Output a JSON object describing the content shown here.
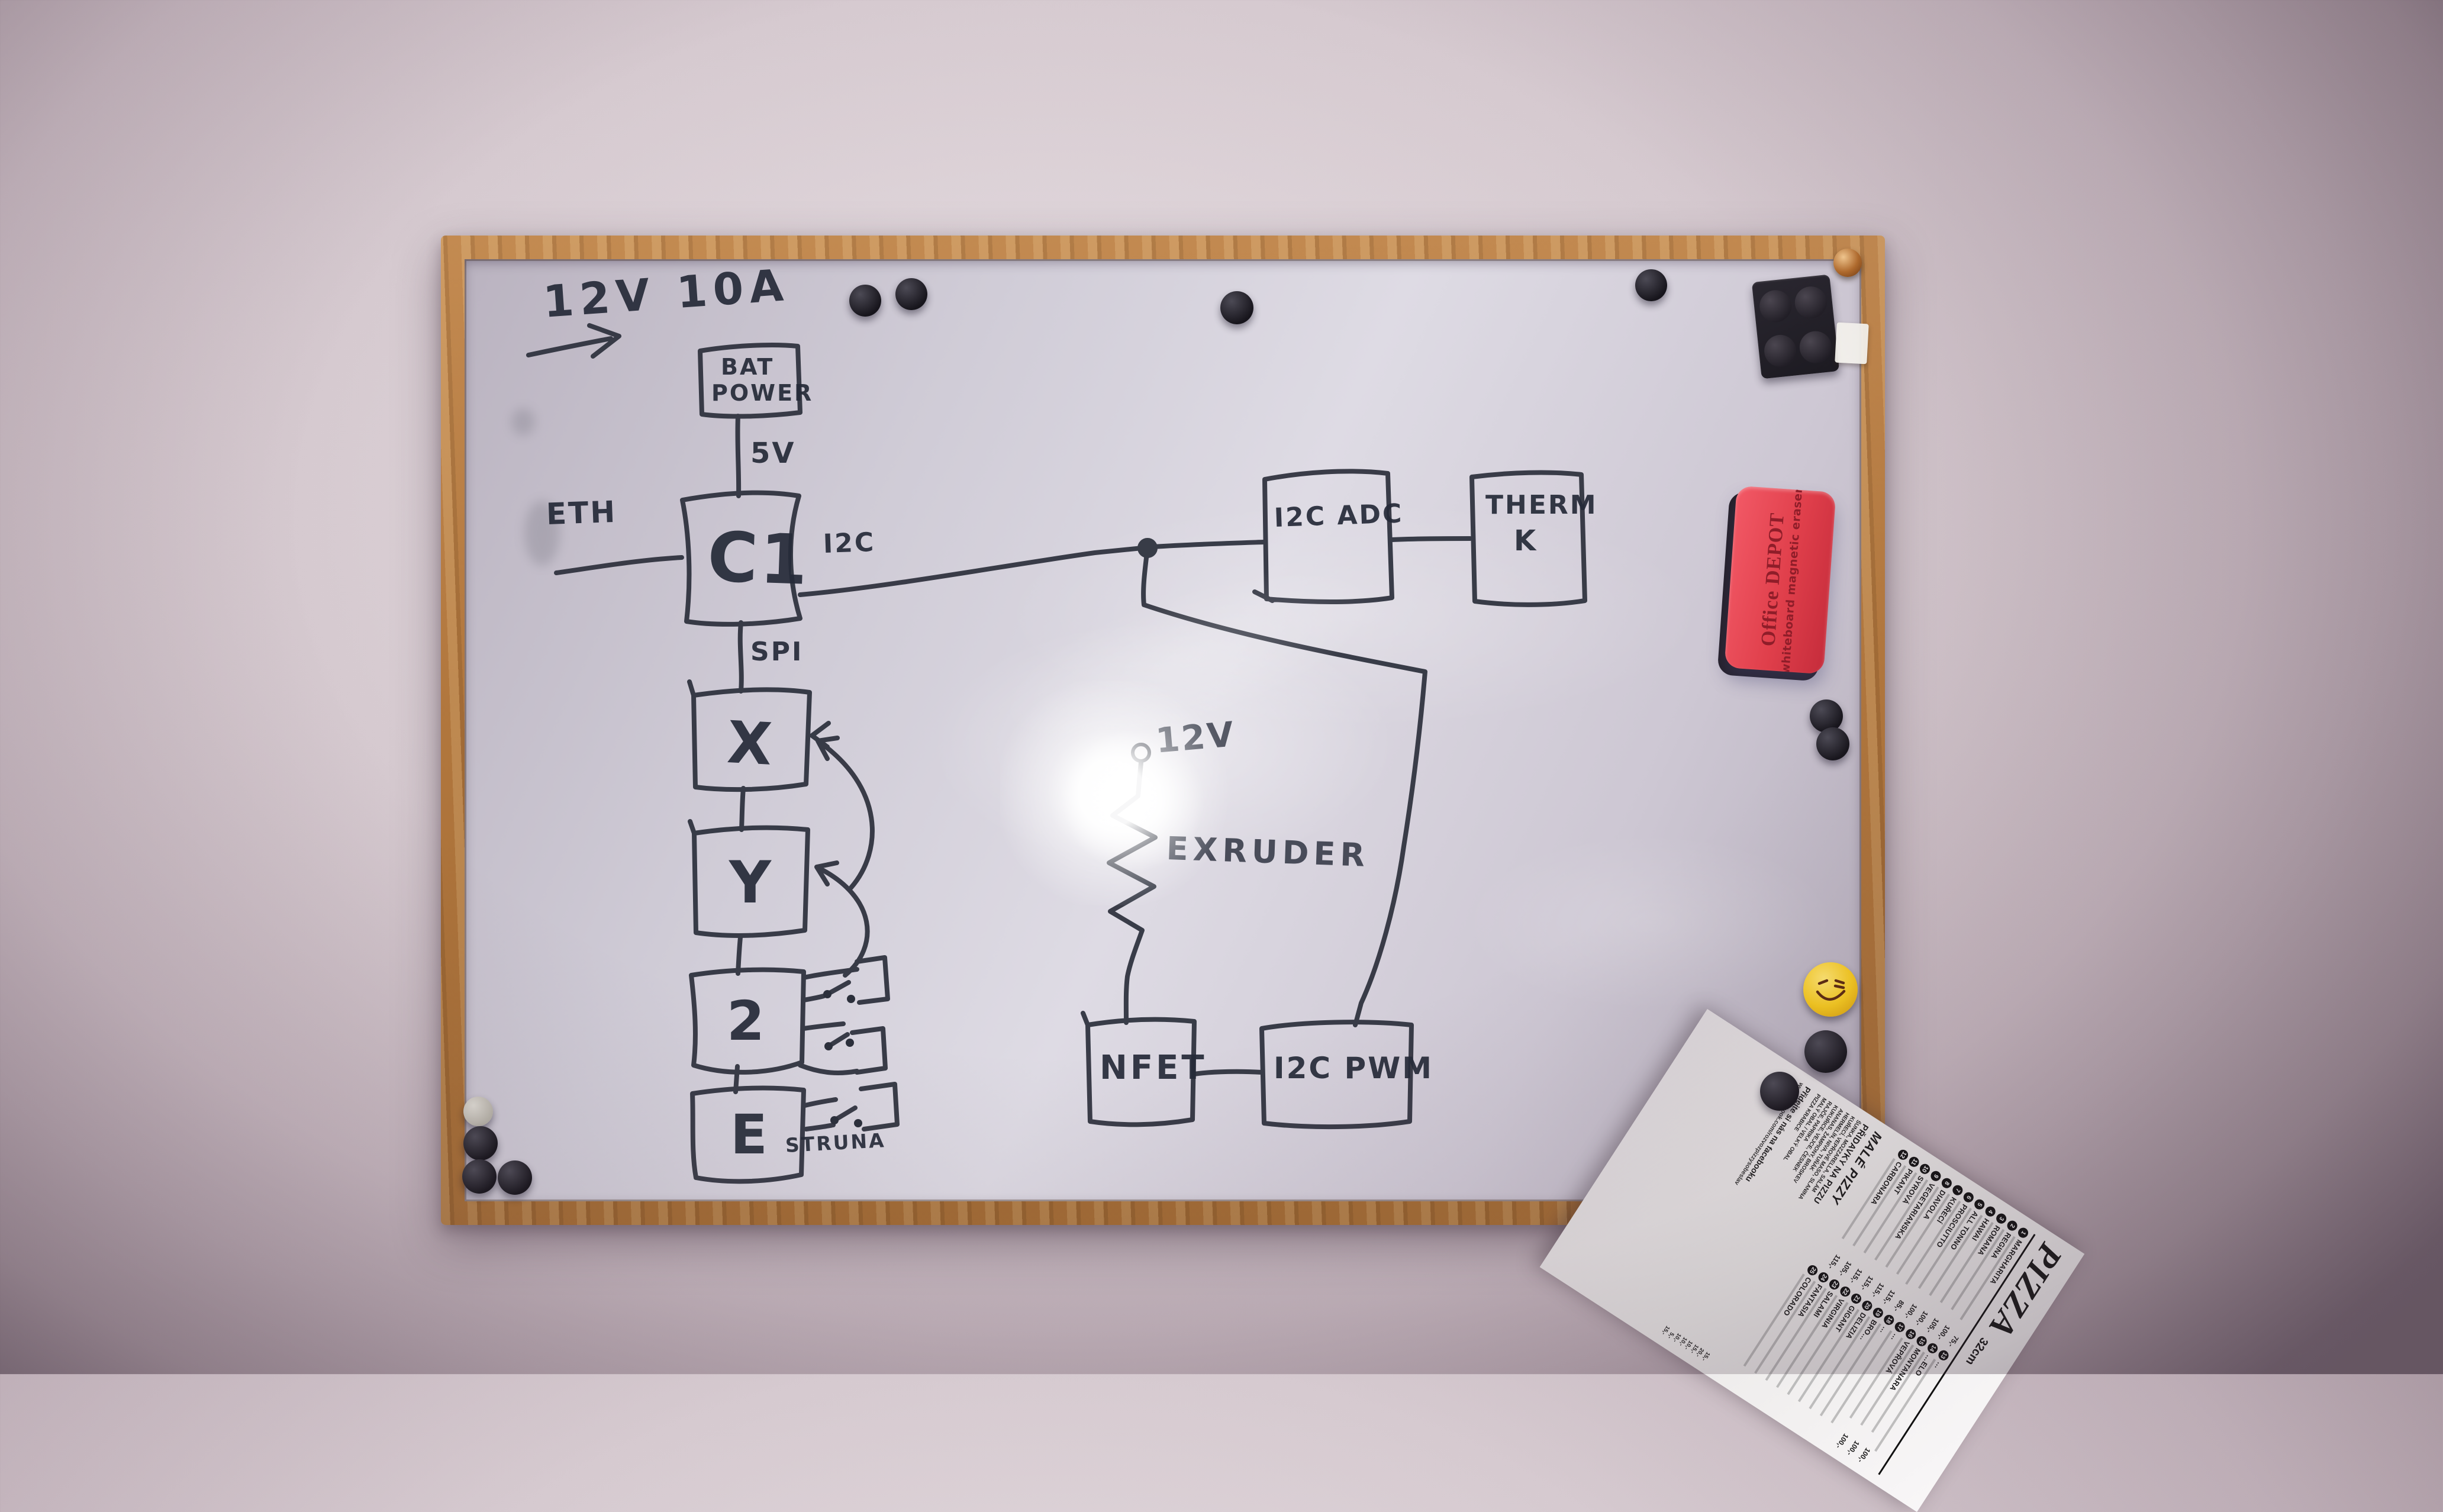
{
  "whiteboard": {
    "labels": {
      "supply": "12V 10A",
      "bat1": "BAT",
      "bat2": "POWER",
      "v5": "5V",
      "eth": "ETH",
      "c1": "C1",
      "i2c": "I2C",
      "adc": "I2C ADC",
      "therm1": "THERM",
      "therm2": "K",
      "spi": "SPI",
      "x": "X",
      "y": "Y",
      "z": "2",
      "e": "E",
      "struna": "STRUNA",
      "v12": "12V",
      "extruder": "EXRUDER",
      "nfet": "NFET",
      "pwm": "I2C PWM"
    }
  },
  "eraser": {
    "brand": "Office DEPOT",
    "product": "whiteboard magnetic eraser"
  },
  "menu": {
    "title": "PIZZA",
    "size": "32cm",
    "items_col1": [
      {
        "num": "1",
        "name": "MARGHARITA",
        "price": "75,-"
      },
      {
        "num": "2",
        "name": "REGINA",
        "price": "100,-"
      },
      {
        "num": "3",
        "name": "ROMANA",
        "price": "105,-"
      },
      {
        "num": "4",
        "name": "HAWAI",
        "price": "100,-"
      },
      {
        "num": "5",
        "name": "ALL TONNO",
        "price": "100,-"
      },
      {
        "num": "6",
        "name": "PROSCIUTTO",
        "price": "85,-"
      },
      {
        "num": "7",
        "name": "KUŘECÍ",
        "price": "115,-"
      },
      {
        "num": "8",
        "name": "DIAVOLA",
        "price": "115,-"
      },
      {
        "num": "9",
        "name": "VEGETARIANSKA",
        "price": "115,-"
      },
      {
        "num": "10",
        "name": "SYROVÁ",
        "price": "115,-"
      },
      {
        "num": "11",
        "name": "PIKANT",
        "price": "105,-"
      },
      {
        "num": "12",
        "name": "CARBONARA",
        "price": "115,-"
      }
    ],
    "items_col2": [
      {
        "num": "13",
        "name": "…",
        "price": ""
      },
      {
        "num": "14",
        "name": "…ELO",
        "price": "100,-"
      },
      {
        "num": "15",
        "name": "MONTANARA",
        "price": "100,-"
      },
      {
        "num": "16",
        "name": "VEPŘOVÁ",
        "price": "100,-"
      },
      {
        "num": "17",
        "name": "…",
        "price": ""
      },
      {
        "num": "18",
        "name": "…",
        "price": ""
      },
      {
        "num": "19",
        "name": "BRO…",
        "price": ""
      },
      {
        "num": "20",
        "name": "DELIZIA",
        "price": ""
      },
      {
        "num": "21",
        "name": "GIGANT",
        "price": ""
      },
      {
        "num": "22",
        "name": "VIRGINIA",
        "price": ""
      },
      {
        "num": "23",
        "name": "SALAMI",
        "price": ""
      },
      {
        "num": "24",
        "name": "FANTASIA",
        "price": ""
      },
      {
        "num": "25",
        "name": "COLORADO",
        "price": ""
      }
    ],
    "small_heading": "MALÉ PIZZY",
    "toppings_heading": "PŘIDAVKY NA PIZZU",
    "toppings": [
      {
        "name": "ŠUNKA, MOZZARELLA, SALÁM",
        "price": "15,-"
      },
      {
        "name": "KUŘECÍ, VEPŘOVÉ MASO, SLANINA",
        "price": "20,-"
      },
      {
        "name": "HERMELÍN, NIVA, TUŇÁK",
        "price": "15,-"
      },
      {
        "name": "ANANAS, ŽAMPIONY, BROSKEV",
        "price": "10,-"
      },
      {
        "name": "KUKUŘICE, VEJCE, ČESNEK",
        "price": "10,-"
      },
      {
        "name": "RAJČE, PAPRIKA",
        "price": "10,-"
      },
      {
        "name": "MALÝ OBAL / VELKÝ OBAL",
        "price": "5,-"
      },
      {
        "name": "PIZZA KRABICE",
        "price": "15,-"
      }
    ],
    "facebook": "Přidejte si nás na facebooku",
    "url": "www.facebook.com/rozvozpizzysobeslav"
  },
  "colors": {
    "ink": "#2b2f3b",
    "wood_frame": "#b2783f",
    "wall": "#d6cad0",
    "board_surface": "#d6d2dc",
    "eraser_red": "#e03f4b",
    "smiley_yellow": "#f5c81e",
    "menu_paper": "#f1eeef",
    "magnet_black": "#17151c"
  }
}
